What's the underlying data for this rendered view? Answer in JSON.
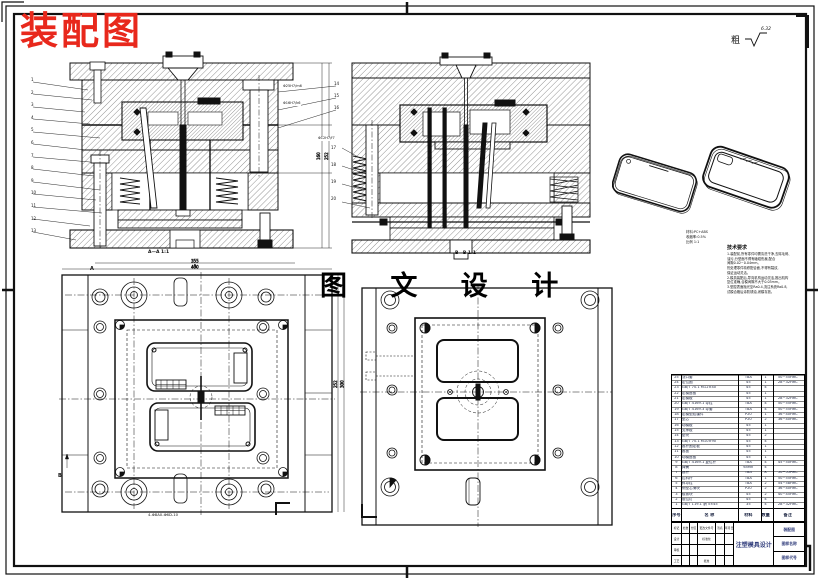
{
  "stamp": {
    "text": "装配图",
    "color": "#e8281c"
  },
  "watermark": {
    "text": "图 文 设 计"
  },
  "finish": {
    "prefix": "粗",
    "value": "6.32"
  },
  "sections": {
    "a_label": "A—A 1:1",
    "b_label": "B—B 1:1",
    "plan_dim": "4-Φ8A0-Φ6D-10",
    "datum_b": "B",
    "datum_a1": "A",
    "datum_a2": "A",
    "fit1": "Φ25H7/m6",
    "fit2": "Φ16H7/k6",
    "fit3": "Φ12H7/f7"
  },
  "dims": {
    "plan_top_1": "355",
    "plan_top_2": "400",
    "plan_right_1": "252",
    "plan_right_2": "300",
    "sec_right_1": "160",
    "sec_right_2": "252"
  },
  "balloons": {
    "a_left": [
      "1",
      "2",
      "3",
      "4",
      "5",
      "6",
      "7",
      "8",
      "9",
      "10",
      "11",
      "12",
      "13"
    ],
    "a_right": [
      "14",
      "15",
      "16"
    ],
    "b_left": [
      "17",
      "18",
      "19",
      "20"
    ]
  },
  "phone_note": {
    "lines": [
      "材料:PC+ABS",
      "收缩率:0.5%",
      "比例 1:1"
    ]
  },
  "tech": {
    "title": "技术要求",
    "lines": [
      "1.装配前,所有零件均需清洗干净,去除毛刺、",
      "油污,分型面不得有磕碰伤痕,配合",
      "间隙0.02~0.04mm。",
      "热处理零件精修配合面,不得有裂纹,",
      "保证运动灵活。",
      "2.模具装配后,导向机构运动灵活,推出机构",
      "复位准确,合模间隙不大于0.03mm。",
      "3.型腔表面抛光至Ra0.4,浇注系统Ra0.8,",
      "试模合格后涂防锈油,闭模存放。"
    ]
  },
  "bom": {
    "headers": {
      "no": "序号",
      "name": "名  称",
      "mat": "材料",
      "qty": "数量",
      "note": "备注"
    },
    "rows": [
      [
        "25",
        "浇口套",
        "T8A",
        "1",
        "50~55HRC"
      ],
      [
        "24",
        "定位圈",
        "45",
        "1",
        "28~32HRC"
      ],
      [
        "23",
        "GB/T 70.1 M12×40",
        "45",
        "4",
        ""
      ],
      [
        "22",
        "定模座板",
        "45",
        "1",
        ""
      ],
      [
        "21",
        "定模板",
        "45",
        "1",
        "28~32HRC"
      ],
      [
        "20",
        "GB/T 4169.1 导柱",
        "T8A",
        "4",
        "50~55HRC"
      ],
      [
        "19",
        "GB/T 4169.3 导套",
        "T8A",
        "4",
        "50~55HRC"
      ],
      [
        "18",
        "定模型腔镶件",
        "P20",
        "1",
        "36~40HRC"
      ],
      [
        "17",
        "型芯",
        "P20",
        "2",
        "36~40HRC"
      ],
      [
        "16",
        "动模板",
        "45",
        "1",
        ""
      ],
      [
        "15",
        "支承板",
        "45",
        "1",
        ""
      ],
      [
        "14",
        "垫块",
        "45",
        "2",
        ""
      ],
      [
        "13",
        "GB/T 70.1 M10×90",
        "45",
        "4",
        ""
      ],
      [
        "12",
        "推杆固定板",
        "45",
        "1",
        ""
      ],
      [
        "11",
        "推板",
        "45",
        "1",
        ""
      ],
      [
        "10",
        "动模座板",
        "45",
        "1",
        ""
      ],
      [
        "9",
        "GB/T 4169.1 复位杆",
        "T8A",
        "4",
        "45~50HRC"
      ],
      [
        "8",
        "弹簧",
        "65Mn",
        "4",
        ""
      ],
      [
        "7",
        "推杆",
        "T8A",
        "8",
        "50~55HRC"
      ],
      [
        "6",
        "拉料杆",
        "T8A",
        "1",
        "50~55HRC"
      ],
      [
        "5",
        "斜导柱",
        "T8A",
        "2",
        "54~58HRC"
      ],
      [
        "4",
        "侧型芯滑块",
        "P20",
        "2",
        "36~40HRC"
      ],
      [
        "3",
        "楔紧块",
        "45",
        "2",
        "40~45HRC"
      ],
      [
        "2",
        "限位钉",
        "45",
        "4",
        ""
      ],
      [
        "1",
        "GB/T 119.1 销 5×45",
        "35",
        "4",
        "28~32HRC"
      ]
    ]
  },
  "titleblock": {
    "project": "注塑模具设计",
    "drawing": "装配图",
    "name_label": "图样名称",
    "code_label": "图样代号",
    "row_top": [
      "标记",
      "处数",
      "分区",
      "更改文件号",
      "签名",
      "年月日"
    ],
    "row_design": [
      "设计",
      "",
      "",
      "标准化",
      "",
      ""
    ],
    "row_check": [
      "审核",
      "",
      "",
      "",
      "",
      ""
    ],
    "row_process": [
      "工艺",
      "",
      "",
      "批准",
      "",
      ""
    ]
  }
}
